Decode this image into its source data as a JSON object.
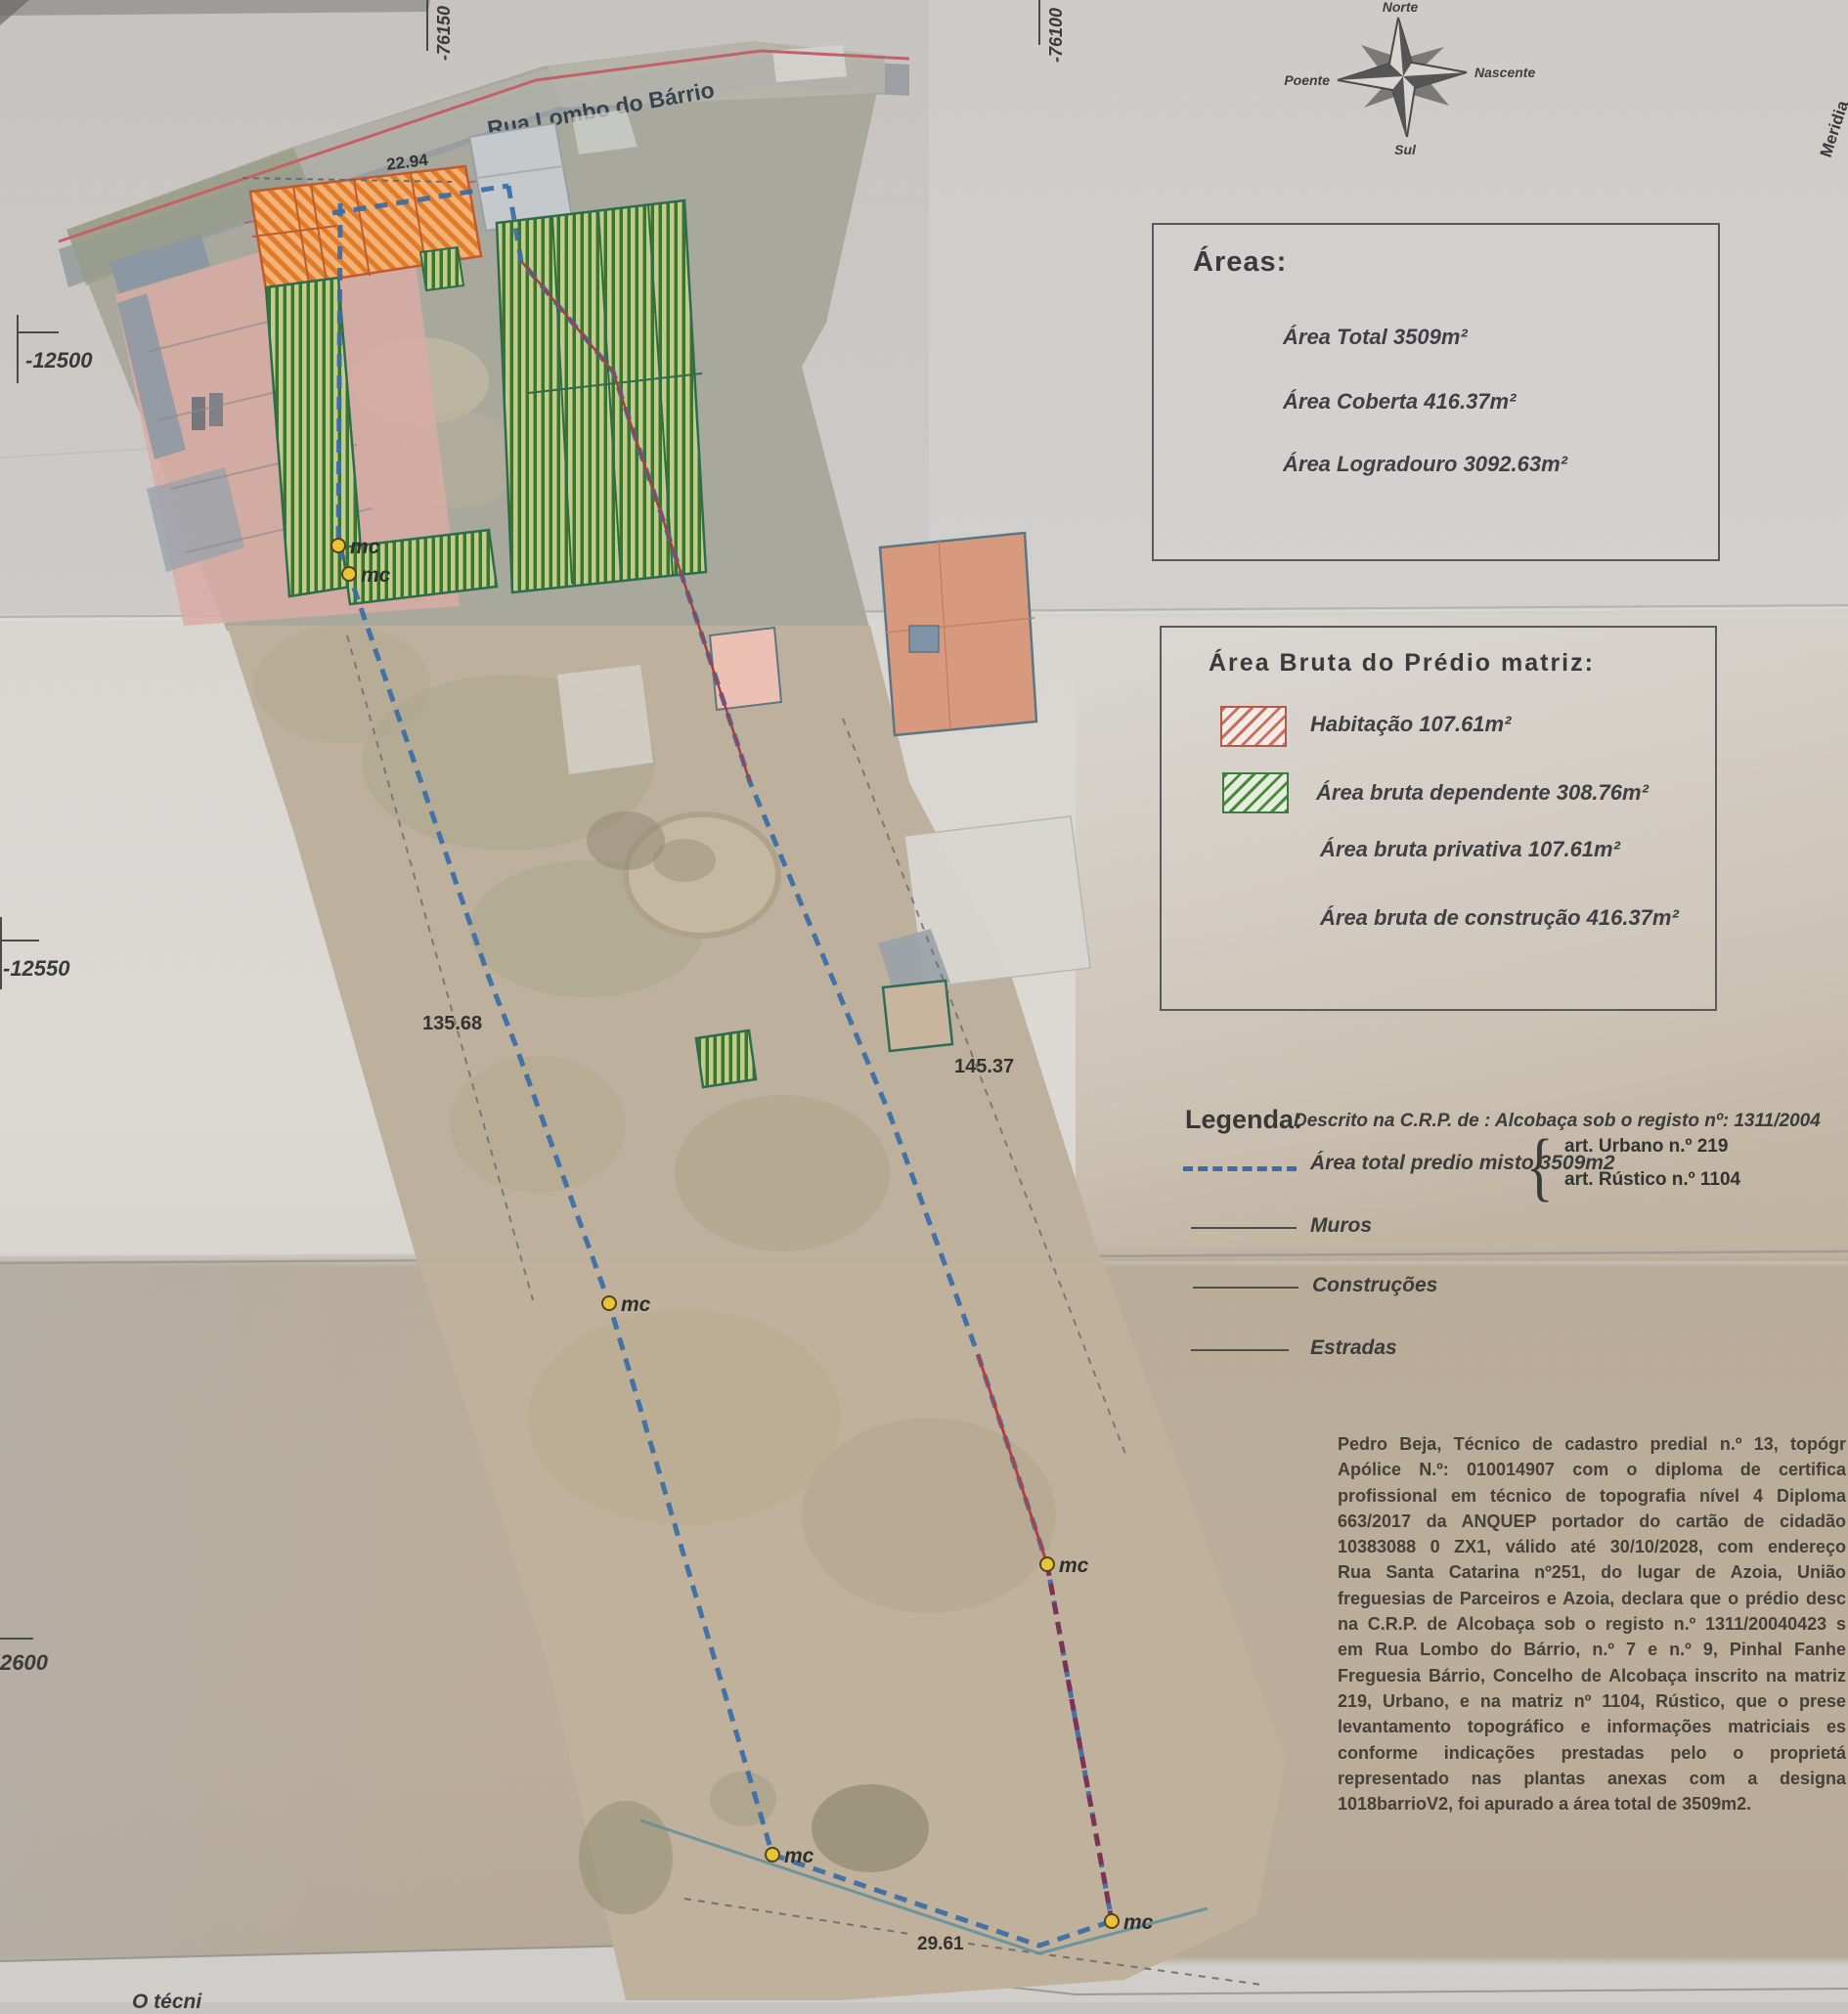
{
  "compass": {
    "north": "Norte",
    "south": "Sul",
    "east": "Nascente",
    "west": "Poente"
  },
  "grid": {
    "top_ticks": [
      "-76150",
      "-76100"
    ],
    "left_ticks": [
      "-12500",
      "-12550",
      "2600"
    ],
    "right_edge_label": "Meridia"
  },
  "map": {
    "street": "Rua Lombo do Bárrio",
    "marker_label": "mc",
    "frontage": "22.94",
    "left_side": "135.68",
    "right_side": "145.37",
    "bottom": "29.61",
    "bottom_corner_text": "O técni"
  },
  "areas_box": {
    "title": "Áreas:",
    "total": "Área Total 3509m²",
    "coberta": "Área  Coberta 416.37m²",
    "logradouro": "Área Logradouro 3092.63m²"
  },
  "bruta_box": {
    "title": "Área Bruta do Prédio matriz:",
    "habitacao": "Habitação 107.61m²",
    "dependente": "Área bruta dependente 308.76m²",
    "privativa": "Área bruta privativa 107.61m²",
    "construcao": "Área bruta de construção 416.37m²"
  },
  "legend": {
    "title": "Legenda:",
    "registry": "Descrito na C.R.P. de : Alcobaça sob o registo nº: 1311/2004",
    "total_row": "Área total predio misto 3509m2",
    "art_urbano": "art.  Urbano n.º 219",
    "art_rustico": "art.  Rústico n.º 1104",
    "muros": "Muros",
    "construcoes": "Construções",
    "estradas": "Estradas"
  },
  "declaration": {
    "lines": [
      "Pedro Beja, Técnico de cadastro predial n.º 13, topógr",
      "Apólice N.º: 010014907 com o diploma de certifica",
      "profissional em técnico de topografia nível 4 Diploma",
      "663/2017 da ANQUEP portador do cartão de cidadão",
      "10383088 0 ZX1, válido até 30/10/2028, com endereço",
      "Rua Santa Catarina nº251, do lugar de Azoia, União",
      "freguesias de Parceiros e Azoia, declara que o prédio desc",
      "na C.R.P. de Alcobaça sob o registo n.º 1311/20040423 s",
      "em Rua Lombo do Bárrio, n.º 7 e n.º 9, Pinhal Fanhe",
      "Freguesia Bárrio, Concelho de Alcobaça inscrito na matriz",
      "219, Urbano, e na matriz nº 1104, Rústico,  que o prese",
      "levantamento topográfico e informações matriciais es",
      "conforme indicações prestadas pelo o proprietá",
      "representado nas plantas anexas com a designa",
      "1018barrioV2, foi apurado a área total de 3509m2."
    ]
  },
  "colors": {
    "boundary_blue": "#3a6ca5",
    "wall_red": "#a04048",
    "boundary_maroon": "#7c3355",
    "construction_teal": "#2f6b4f",
    "hatch_orange": "#dd7a28",
    "hatch_green": "#3f7428",
    "marker_yellow": "#e9c437",
    "road_red": "#c4606a",
    "paper_grey": "#cbc8c5",
    "paper_tan": "#b9ac99",
    "ink": "#3b3b3b"
  }
}
